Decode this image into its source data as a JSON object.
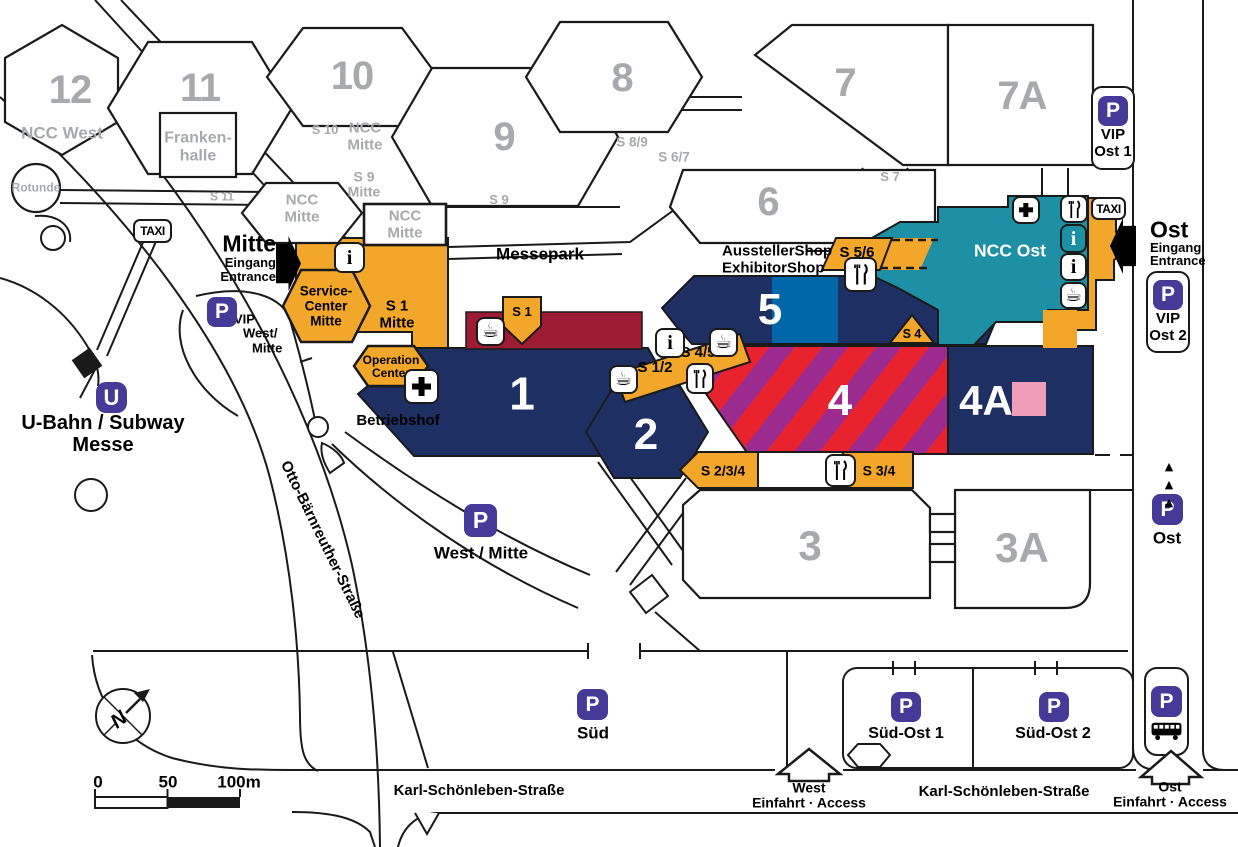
{
  "colors": {
    "navy": "#1e2f63",
    "orange": "#f2a72b",
    "teal": "#1d90a5",
    "light_blue": "#0068a8",
    "stripe_red": "#e8232d",
    "stripe_purple": "#9c2b90",
    "dark_red": "#9e1c33",
    "pink": "#ef9db9",
    "badge_purple": "#463a99",
    "hall_number_gray": "#a7a9ac",
    "ink": "#1a1a1a"
  },
  "halls": {
    "h1": "1",
    "h2": "2",
    "h3": "3",
    "h3a": "3A",
    "h4": "4",
    "h4a": "4A",
    "h5": "5",
    "h6": "6",
    "h7": "7",
    "h7a": "7A",
    "h8": "8",
    "h9": "9",
    "h10": "10",
    "h11": "11",
    "h12": "12"
  },
  "areas": {
    "ncc_west": "NCC West",
    "ncc_mitte_line1": "NCC",
    "ncc_mitte_line2": "Mitte",
    "ncc_ost": "NCC Ost",
    "frankenhalle_line1": "Franken-",
    "frankenhalle_line2": "halle",
    "rotunde": "Rotunde",
    "messepark": "Messepark",
    "betriebshof": "Betriebshof",
    "service_center_line1": "Service-",
    "service_center_line2": "Center",
    "service_center_line3": "Mitte",
    "operation_center_line1": "Operation",
    "operation_center_line2": "Center"
  },
  "shop": {
    "line1": "AusstellerShop",
    "line2": "ExhibitorShop"
  },
  "s_labels": {
    "s1": "S 1",
    "s1_mitte_line1": "S 1",
    "s1_mitte_line2": "Mitte",
    "s1_2": "S 1/2",
    "s2_3_4": "S 2/3/4",
    "s3_4": "S 3/4",
    "s4": "S 4",
    "s4_5": "S 4/5",
    "s5_6": "S 5/6",
    "s6_7": "S 6/7",
    "s7": "S 7",
    "s8_9": "S 8/9",
    "s9": "S 9",
    "s9_mitte_line1": "S 9",
    "s9_mitte_line2": "Mitte",
    "s10": "S 10",
    "s11": "S 11"
  },
  "entrances": {
    "mitte_title": "Mitte",
    "mitte_line1": "Eingang",
    "mitte_line2": "Entrance",
    "ost_title": "Ost",
    "ost_line1": "Eingang",
    "ost_line2": "Entrance",
    "west_access_title": "West",
    "west_access_sub": "Einfahrt · Access",
    "ost_access_title": "Ost",
    "ost_access_sub": "Einfahrt · Access"
  },
  "parking": {
    "p": "P",
    "vip_ost1_line1": "VIP",
    "vip_ost1_line2": "Ost 1",
    "vip_ost2_line1": "VIP",
    "vip_ost2_line2": "Ost 2",
    "vip_west_line1": "VIP",
    "vip_west_line2": "West/",
    "vip_west_line3": "Mitte",
    "west_mitte": "West / Mitte",
    "sued": "Süd",
    "sued_ost1": "Süd-Ost 1",
    "sued_ost2": "Süd-Ost 2",
    "ost": "Ost"
  },
  "transit": {
    "taxi": "TAXI",
    "u": "U",
    "ubahn_line1": "U-Bahn / Subway",
    "ubahn_line2": "Messe"
  },
  "streets": {
    "otto": "Otto-Bärnreuther-Straße",
    "karl_west": "Karl-Schönleben-Straße",
    "karl_ost": "Karl-Schönleben-Straße"
  },
  "info": {
    "i": "i"
  },
  "compass": {
    "n": "N"
  },
  "scale_bar": {
    "zero": "0",
    "fifty": "50",
    "hundred": "100m"
  }
}
